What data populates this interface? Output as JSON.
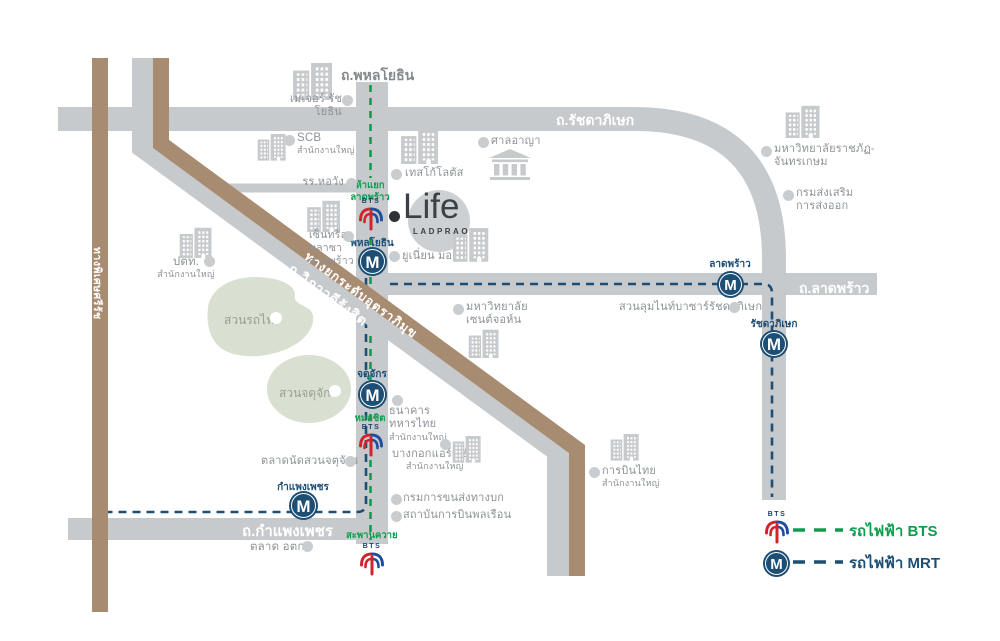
{
  "title": "Life Ladprao location map",
  "logo": {
    "dot": "•",
    "name": "Life",
    "sub": "LADPRAO"
  },
  "roads": {
    "phahonyothin": "ถ.พหลโยธิน",
    "ratchadaphisek": "ถ.รัชดาภิเษก",
    "latphrao": "ถ.ลาดพร้าว",
    "kamphaengphet": "ถ.กำแพงเพชร",
    "vibhavadi": "ถ.วิภาวดีรังสิต",
    "tollway": "ทางยกระดับอุตราภิมุข",
    "sirat": "ทางพิเศษศรีรัช"
  },
  "parks": {
    "rotfai": "สวนรถไฟ",
    "chatuchak": "สวนจตุจักร"
  },
  "stations": {
    "bts_word": "BTS",
    "m_letter": "M",
    "bts": {
      "hayaek_l1": "ห้าแยก",
      "hayaek_l2": "ลาดพร้าว",
      "mochit": "หมอชิต",
      "saphankhwai": "สะพานควาย"
    },
    "mrt": {
      "phahonyothin": "พหลโยธิน",
      "chatuchak": "จตุจักร",
      "kamphaengphet": "กำแพงเพชร",
      "latphrao": "ลาดพร้าว",
      "ratchadaphisek": "รัชดาภิเษก"
    }
  },
  "pois": {
    "major": "เมเจอร์ รัชโยธิน",
    "scb": {
      "l1": "SCB",
      "l2": "สำนักงานใหญ่"
    },
    "horwang": "รร.หอวัง",
    "tesco": "เทสโก้โลตัส",
    "court": "ศาลอาญา",
    "central": {
      "l1": "เซ็นทรัล",
      "l2": "พลาซา",
      "l3": "ลาดพร้าว"
    },
    "union": "ยูเนี่ยน มอลล์",
    "ptt": {
      "l1": "ปตท.",
      "l2": "สำนักงานใหญ่"
    },
    "rajabhat": {
      "l1": "มหาวิทยาลัยราชภัฏ-",
      "l2": "จันทรเกษม"
    },
    "export_dept": {
      "l1": "กรมส่งเสริม",
      "l2": "การส่งออก"
    },
    "nightbazaar": "สวนลุมไนท์บาซาร์รัชดาภิเษก",
    "stjohn": {
      "l1": "มหาวิทยาลัย",
      "l2": "เซนต์จอห์น"
    },
    "tmb": {
      "l1": "ธนาคาร",
      "l2": "ทหารไทย",
      "l3": "สำนักงานใหญ่"
    },
    "bkkair": {
      "l1": "บางกอกแอร์เวย์",
      "l2": "สำนักงานใหญ่"
    },
    "dlt": "กรมการขนส่งทางบก",
    "catc": "สถาบันการบินพลเรือน",
    "jjmarket": "ตลาดนัดสวนจตุจักร",
    "otk": "ตลาด อตก.",
    "thaiair": {
      "l1": "การบินไทย",
      "l2": "สำนักงานใหญ่"
    }
  },
  "legend": {
    "bts": "รถไฟฟ้า BTS",
    "mrt": "รถไฟฟ้า MRT"
  },
  "colors": {
    "bts_green": "#0f9d4d",
    "mrt_navy": "#1d4e74",
    "road_gray": "#c7cacd",
    "brown": "#a88c71",
    "park_green": "#d9e0d2",
    "bts_logo_blue": "#1f4e9c",
    "bts_logo_red": "#d2232a"
  }
}
